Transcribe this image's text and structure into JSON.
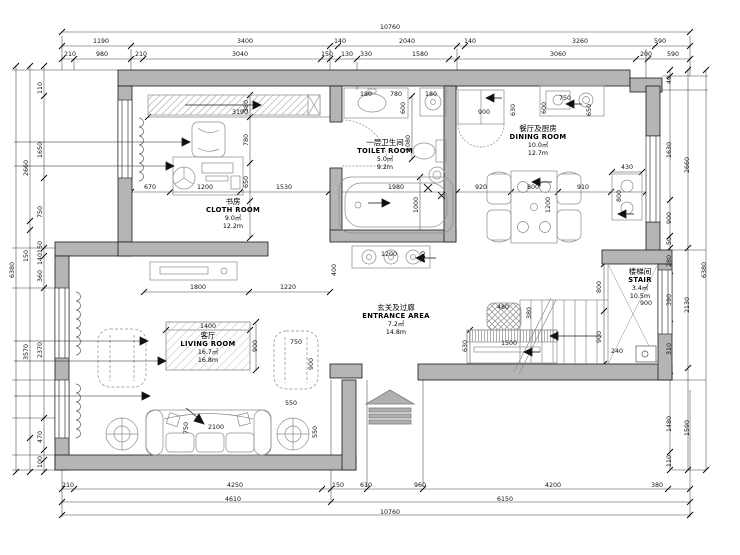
{
  "drawing": {
    "kind": "residential floor plan, first floor"
  },
  "colors": {
    "wall_fill": "#b5b5b5",
    "line": "#1a1a1a",
    "furniture_line": "#8c8c8c",
    "background": "#ffffff"
  },
  "rooms": [
    {
      "id": "study",
      "name_cn": "书房",
      "name_en": "CLOTH ROOM",
      "area": "9.0㎡",
      "perimeter": "12.2m",
      "x": 233,
      "y": 197
    },
    {
      "id": "toilet",
      "name_cn": "一层卫生间",
      "name_en": "TOILET ROOM",
      "area": "5.0㎡",
      "perimeter": "9.2m",
      "x": 385,
      "y": 138
    },
    {
      "id": "dining",
      "name_cn": "餐厅及厨房",
      "name_en": "DINING ROOM",
      "area": "10.0㎡",
      "perimeter": "12.7m",
      "x": 538,
      "y": 124
    },
    {
      "id": "entrance",
      "name_cn": "玄关及过廊",
      "name_en": "ENTRANCE AREA",
      "area": "7.2㎡",
      "perimeter": "14.8m",
      "x": 396,
      "y": 303
    },
    {
      "id": "living",
      "name_cn": "客厅",
      "name_en": "LIVING ROOM",
      "area": "16.7㎡",
      "perimeter": "16.8m",
      "x": 208,
      "y": 331
    },
    {
      "id": "stair",
      "name_cn": "楼梯间",
      "name_en": "STAIR",
      "area": "3.4㎡",
      "perimeter": "10.5m",
      "x": 640,
      "y": 267
    }
  ],
  "dimensions": [
    {
      "t": "10760",
      "x": 390,
      "y": 28
    },
    {
      "t": "1190",
      "x": 101,
      "y": 42
    },
    {
      "t": "3400",
      "x": 245,
      "y": 42
    },
    {
      "t": "140",
      "x": 340,
      "y": 42
    },
    {
      "t": "2040",
      "x": 407,
      "y": 42
    },
    {
      "t": "140",
      "x": 470,
      "y": 42
    },
    {
      "t": "3260",
      "x": 580,
      "y": 42
    },
    {
      "t": "590",
      "x": 660,
      "y": 42
    },
    {
      "t": "210",
      "x": 70,
      "y": 55
    },
    {
      "t": "980",
      "x": 102,
      "y": 55
    },
    {
      "t": "210",
      "x": 141,
      "y": 55
    },
    {
      "t": "3040",
      "x": 240,
      "y": 55
    },
    {
      "t": "150",
      "x": 327,
      "y": 55
    },
    {
      "t": "130",
      "x": 347,
      "y": 55
    },
    {
      "t": "330",
      "x": 366,
      "y": 55
    },
    {
      "t": "1580",
      "x": 420,
      "y": 55
    },
    {
      "t": "3060",
      "x": 558,
      "y": 55
    },
    {
      "t": "200",
      "x": 646,
      "y": 55
    },
    {
      "t": "590",
      "x": 673,
      "y": 55
    },
    {
      "t": "210",
      "x": 68,
      "y": 486
    },
    {
      "t": "4250",
      "x": 235,
      "y": 486
    },
    {
      "t": "150",
      "x": 338,
      "y": 486
    },
    {
      "t": "610",
      "x": 366,
      "y": 486
    },
    {
      "t": "960",
      "x": 420,
      "y": 486
    },
    {
      "t": "4200",
      "x": 553,
      "y": 486
    },
    {
      "t": "380",
      "x": 657,
      "y": 486
    },
    {
      "t": "4610",
      "x": 233,
      "y": 500
    },
    {
      "t": "6150",
      "x": 505,
      "y": 500
    },
    {
      "t": "10760",
      "x": 390,
      "y": 513
    },
    {
      "t": "6380",
      "x": 13,
      "y": 270,
      "r": 1
    },
    {
      "t": "2660",
      "x": 27,
      "y": 168,
      "r": 1
    },
    {
      "t": "150",
      "x": 27,
      "y": 256,
      "r": 1
    },
    {
      "t": "3570",
      "x": 27,
      "y": 352,
      "r": 1
    },
    {
      "t": "110",
      "x": 41,
      "y": 88,
      "r": 1
    },
    {
      "t": "1650",
      "x": 41,
      "y": 150,
      "r": 1
    },
    {
      "t": "750",
      "x": 41,
      "y": 212,
      "r": 1
    },
    {
      "t": "150",
      "x": 41,
      "y": 247,
      "r": 1
    },
    {
      "t": "140",
      "x": 41,
      "y": 259,
      "r": 1
    },
    {
      "t": "360",
      "x": 41,
      "y": 276,
      "r": 1
    },
    {
      "t": "2370",
      "x": 41,
      "y": 350,
      "r": 1
    },
    {
      "t": "470",
      "x": 41,
      "y": 437,
      "r": 1
    },
    {
      "t": "100",
      "x": 41,
      "y": 462,
      "r": 1
    },
    {
      "t": "6380",
      "x": 705,
      "y": 270,
      "r": 1
    },
    {
      "t": "2660",
      "x": 688,
      "y": 165,
      "r": 1
    },
    {
      "t": "2130",
      "x": 688,
      "y": 305,
      "r": 1
    },
    {
      "t": "1590",
      "x": 688,
      "y": 428,
      "r": 1
    },
    {
      "t": "40",
      "x": 670,
      "y": 80,
      "r": 1
    },
    {
      "t": "1630",
      "x": 670,
      "y": 150,
      "r": 1
    },
    {
      "t": "900",
      "x": 670,
      "y": 218,
      "r": 1
    },
    {
      "t": "50",
      "x": 670,
      "y": 241,
      "r": 1
    },
    {
      "t": "280",
      "x": 670,
      "y": 261,
      "r": 1
    },
    {
      "t": "390",
      "x": 670,
      "y": 300,
      "r": 1
    },
    {
      "t": "310",
      "x": 670,
      "y": 349,
      "r": 1
    },
    {
      "t": "1480",
      "x": 670,
      "y": 424,
      "r": 1
    },
    {
      "t": "110",
      "x": 670,
      "y": 461,
      "r": 1
    },
    {
      "t": "3190",
      "x": 240,
      "y": 113
    },
    {
      "t": "380",
      "x": 247,
      "y": 106,
      "r": 1
    },
    {
      "t": "780",
      "x": 247,
      "y": 140,
      "r": 1
    },
    {
      "t": "650",
      "x": 247,
      "y": 182,
      "r": 1
    },
    {
      "t": "670",
      "x": 150,
      "y": 188
    },
    {
      "t": "1200",
      "x": 205,
      "y": 188
    },
    {
      "t": "1530",
      "x": 284,
      "y": 188
    },
    {
      "t": "1980",
      "x": 396,
      "y": 188
    },
    {
      "t": "1000",
      "x": 417,
      "y": 205,
      "r": 1
    },
    {
      "t": "1080",
      "x": 409,
      "y": 143,
      "r": 1
    },
    {
      "t": "180",
      "x": 366,
      "y": 95
    },
    {
      "t": "780",
      "x": 396,
      "y": 95
    },
    {
      "t": "180",
      "x": 431,
      "y": 95
    },
    {
      "t": "600",
      "x": 404,
      "y": 108,
      "r": 1
    },
    {
      "t": "900",
      "x": 484,
      "y": 113
    },
    {
      "t": "630",
      "x": 514,
      "y": 110,
      "r": 1
    },
    {
      "t": "750",
      "x": 565,
      "y": 99
    },
    {
      "t": "600",
      "x": 545,
      "y": 108,
      "r": 1
    },
    {
      "t": "650",
      "x": 590,
      "y": 110,
      "r": 1
    },
    {
      "t": "920",
      "x": 481,
      "y": 188
    },
    {
      "t": "800",
      "x": 533,
      "y": 188
    },
    {
      "t": "910",
      "x": 583,
      "y": 188
    },
    {
      "t": "1200",
      "x": 549,
      "y": 205,
      "r": 1
    },
    {
      "t": "430",
      "x": 627,
      "y": 168
    },
    {
      "t": "800",
      "x": 620,
      "y": 196,
      "r": 1
    },
    {
      "t": "1800",
      "x": 198,
      "y": 288
    },
    {
      "t": "1220",
      "x": 288,
      "y": 288
    },
    {
      "t": "400",
      "x": 335,
      "y": 270,
      "r": 1
    },
    {
      "t": "1200",
      "x": 389,
      "y": 255
    },
    {
      "t": "310",
      "x": 424,
      "y": 257,
      "r": 1
    },
    {
      "t": "480",
      "x": 503,
      "y": 308
    },
    {
      "t": "380",
      "x": 530,
      "y": 313,
      "r": 1
    },
    {
      "t": "630",
      "x": 466,
      "y": 346,
      "r": 1
    },
    {
      "t": "1500",
      "x": 509,
      "y": 344
    },
    {
      "t": "800",
      "x": 600,
      "y": 287,
      "r": 1
    },
    {
      "t": "900",
      "x": 600,
      "y": 337,
      "r": 1
    },
    {
      "t": "900",
      "x": 646,
      "y": 304
    },
    {
      "t": "240",
      "x": 617,
      "y": 352
    },
    {
      "t": "1400",
      "x": 208,
      "y": 327
    },
    {
      "t": "900",
      "x": 256,
      "y": 346,
      "r": 1
    },
    {
      "t": "750",
      "x": 296,
      "y": 343
    },
    {
      "t": "900",
      "x": 312,
      "y": 364,
      "r": 1
    },
    {
      "t": "550",
      "x": 291,
      "y": 404
    },
    {
      "t": "550",
      "x": 316,
      "y": 432,
      "r": 1
    },
    {
      "t": "2100",
      "x": 216,
      "y": 428
    },
    {
      "t": "750",
      "x": 187,
      "y": 428,
      "r": 1
    }
  ]
}
